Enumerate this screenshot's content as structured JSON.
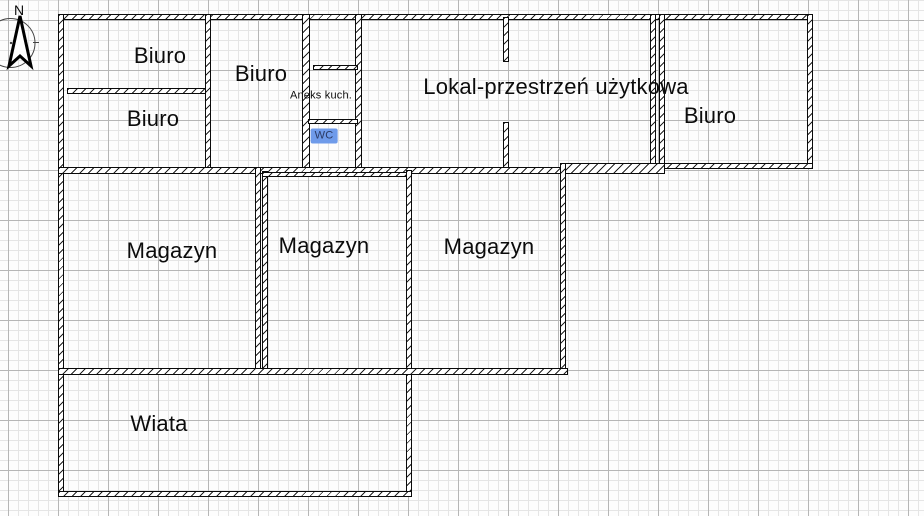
{
  "compass": {
    "north_label": "N"
  },
  "floorplan": {
    "accent_highlight_color": "#6f9bea",
    "rooms": [
      {
        "id": "biuro-top-left",
        "label": "Biuro"
      },
      {
        "id": "biuro-middle",
        "label": "Biuro"
      },
      {
        "id": "biuro-bottom-left",
        "label": "Biuro"
      },
      {
        "id": "aneks-kuchenny",
        "label": "Aneks kuch."
      },
      {
        "id": "wc",
        "label": "WC"
      },
      {
        "id": "lokal",
        "label": "Lokal-przestrzeń użytkowa"
      },
      {
        "id": "biuro-right",
        "label": "Biuro"
      },
      {
        "id": "magazyn-left",
        "label": "Magazyn"
      },
      {
        "id": "magazyn-middle",
        "label": "Magazyn"
      },
      {
        "id": "magazyn-right",
        "label": "Magazyn"
      },
      {
        "id": "wiata",
        "label": "Wiata"
      }
    ]
  }
}
